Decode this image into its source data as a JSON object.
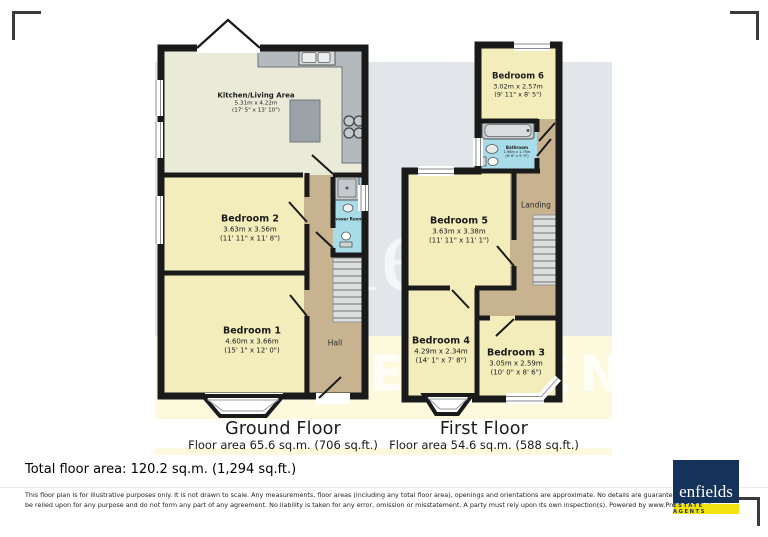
{
  "watermark": {
    "line1": "enfields",
    "line2": "ESTATE AGENTS"
  },
  "plans": [
    {
      "title": "Ground Floor",
      "area_label": "Floor area 65.6 sq.m. (706 sq.ft.)",
      "rooms": [
        {
          "name": "Kitchen/Living Area",
          "metric": "5.31m x 4.22m",
          "imperial": "(17' 5\" x 13' 10\")"
        },
        {
          "name": "Bedroom 2",
          "metric": "3.63m x 3.56m",
          "imperial": "(11' 11\" x 11' 8\")"
        },
        {
          "name": "Bedroom 1",
          "metric": "4.60m x 3.66m",
          "imperial": "(15' 1\" x 12' 0\")"
        },
        {
          "name": "Hall"
        },
        {
          "name": "Shower Room"
        }
      ]
    },
    {
      "title": "First Floor",
      "area_label": "Floor area 54.6 sq.m. (588 sq.ft.)",
      "rooms": [
        {
          "name": "Bedroom 6",
          "metric": "3.02m x 2.57m",
          "imperial": "(9' 11\" x 8' 5\")"
        },
        {
          "name": "Bathroom",
          "metric": "1.98m x 1.75m",
          "imperial": "(6' 6\" x 5' 9\")"
        },
        {
          "name": "Bedroom 5",
          "metric": "3.63m x 3.38m",
          "imperial": "(11' 11\" x 11' 1\")"
        },
        {
          "name": "Landing"
        },
        {
          "name": "Bedroom 4",
          "metric": "4.29m x 2.34m",
          "imperial": "(14' 1\" x 7' 8\")"
        },
        {
          "name": "Bedroom 3",
          "metric": "3.05m x 2.59m",
          "imperial": "(10' 0\" x 8' 6\")"
        }
      ]
    }
  ],
  "totals": {
    "total_label": "Total floor area: 120.2 sq.m. (1,294 sq.ft.)"
  },
  "disclaimer": "This floor plan is for illustrative purposes only. It is not drawn to scale. Any measurements, floor areas (including any total floor area), openings and orientations are approximate. No details are guaranteed, they cannot be relied upon for any purpose and do not form any part of any agreement. No liability is taken for any error, omission or misstatement. A party must rely upon its own inspection(s). Powered by www.Propertybox.io",
  "logo": {
    "name": "enfields",
    "tagline": "ESTATE AGENTS",
    "navy": "#15335a",
    "yellow": "#f2e30e"
  }
}
